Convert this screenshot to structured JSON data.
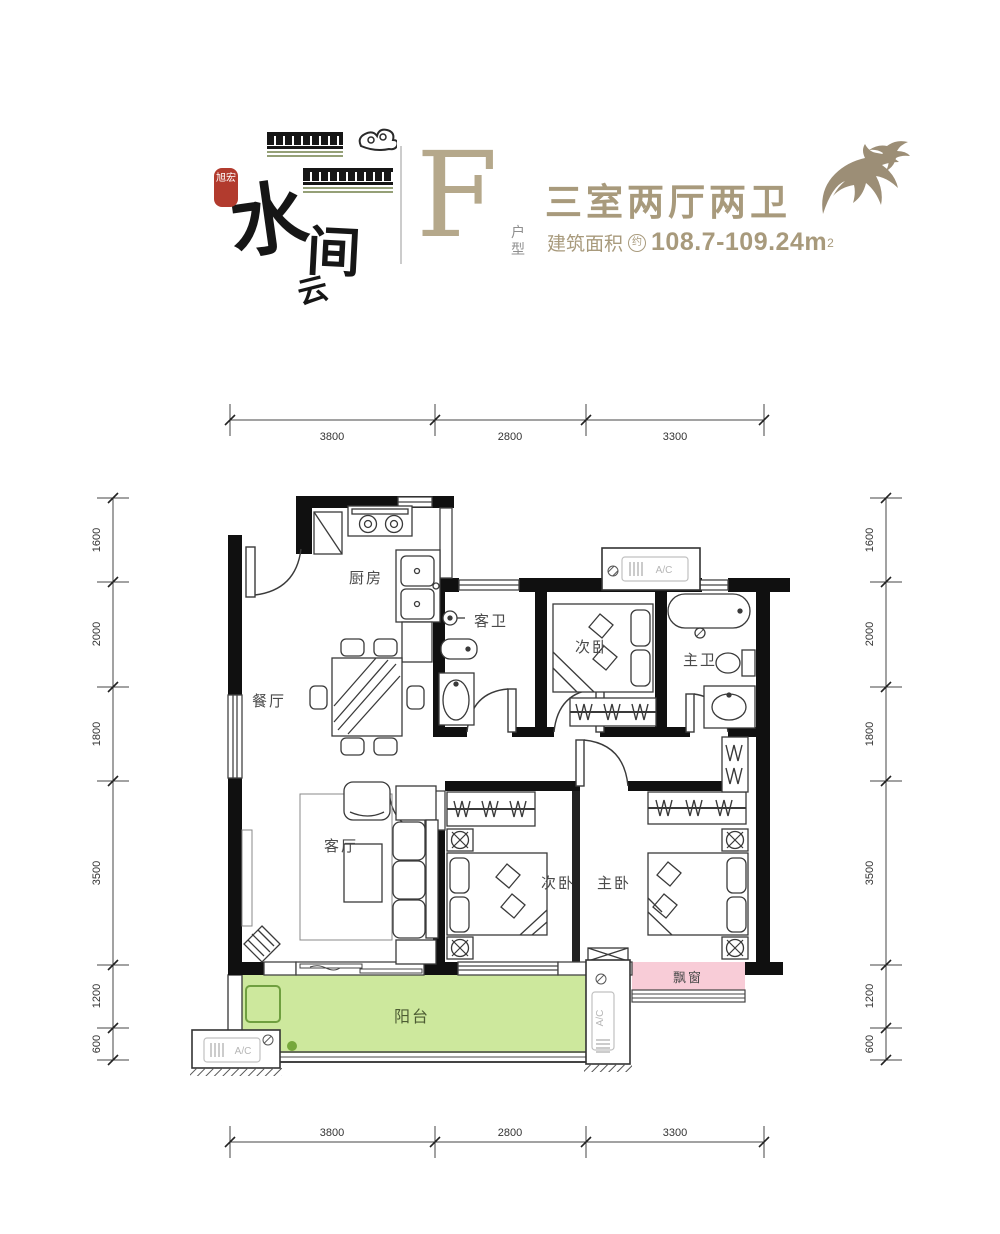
{
  "brand": {
    "logo_main_1": "水",
    "logo_main_2": "云",
    "logo_main_3": "间",
    "logo_seal": "旭宏",
    "unit_letter": "F",
    "unit_label_1": "户",
    "unit_label_2": "型",
    "title": "三室两厅两卫",
    "area_prefix": "建筑面积",
    "area_approx": "约",
    "area_value": "108.7-109.24m",
    "area_sup": "2"
  },
  "rooms": {
    "kitchen": "厨房",
    "dining": "餐厅",
    "guest_bath": "客卫",
    "bedroom2_top": "次卧",
    "master_bath": "主卫",
    "living": "客厅",
    "bedroom2_bottom": "次卧",
    "master_bedroom": "主卧",
    "balcony": "阳台",
    "bay_window": "飘窗",
    "ac": "A/C"
  },
  "dimensions": {
    "top": [
      "3800",
      "2800",
      "3300"
    ],
    "bottom": [
      "3800",
      "2800",
      "3300"
    ],
    "left": [
      "1600",
      "2000",
      "1800",
      "3500",
      "1200",
      "600"
    ],
    "right": [
      "1600",
      "2000",
      "1800",
      "3500",
      "1200",
      "600"
    ]
  },
  "colors": {
    "brand_tan": "#a89a7c",
    "seal_red": "#b23b2e",
    "roof_olive": "#95a077",
    "wall_black": "#101010",
    "balcony_green": "#cde89d",
    "balcony_green_dark": "#76a73c",
    "bay_pink": "#f8ccd7",
    "ac_gray": "#b5b5b5"
  }
}
